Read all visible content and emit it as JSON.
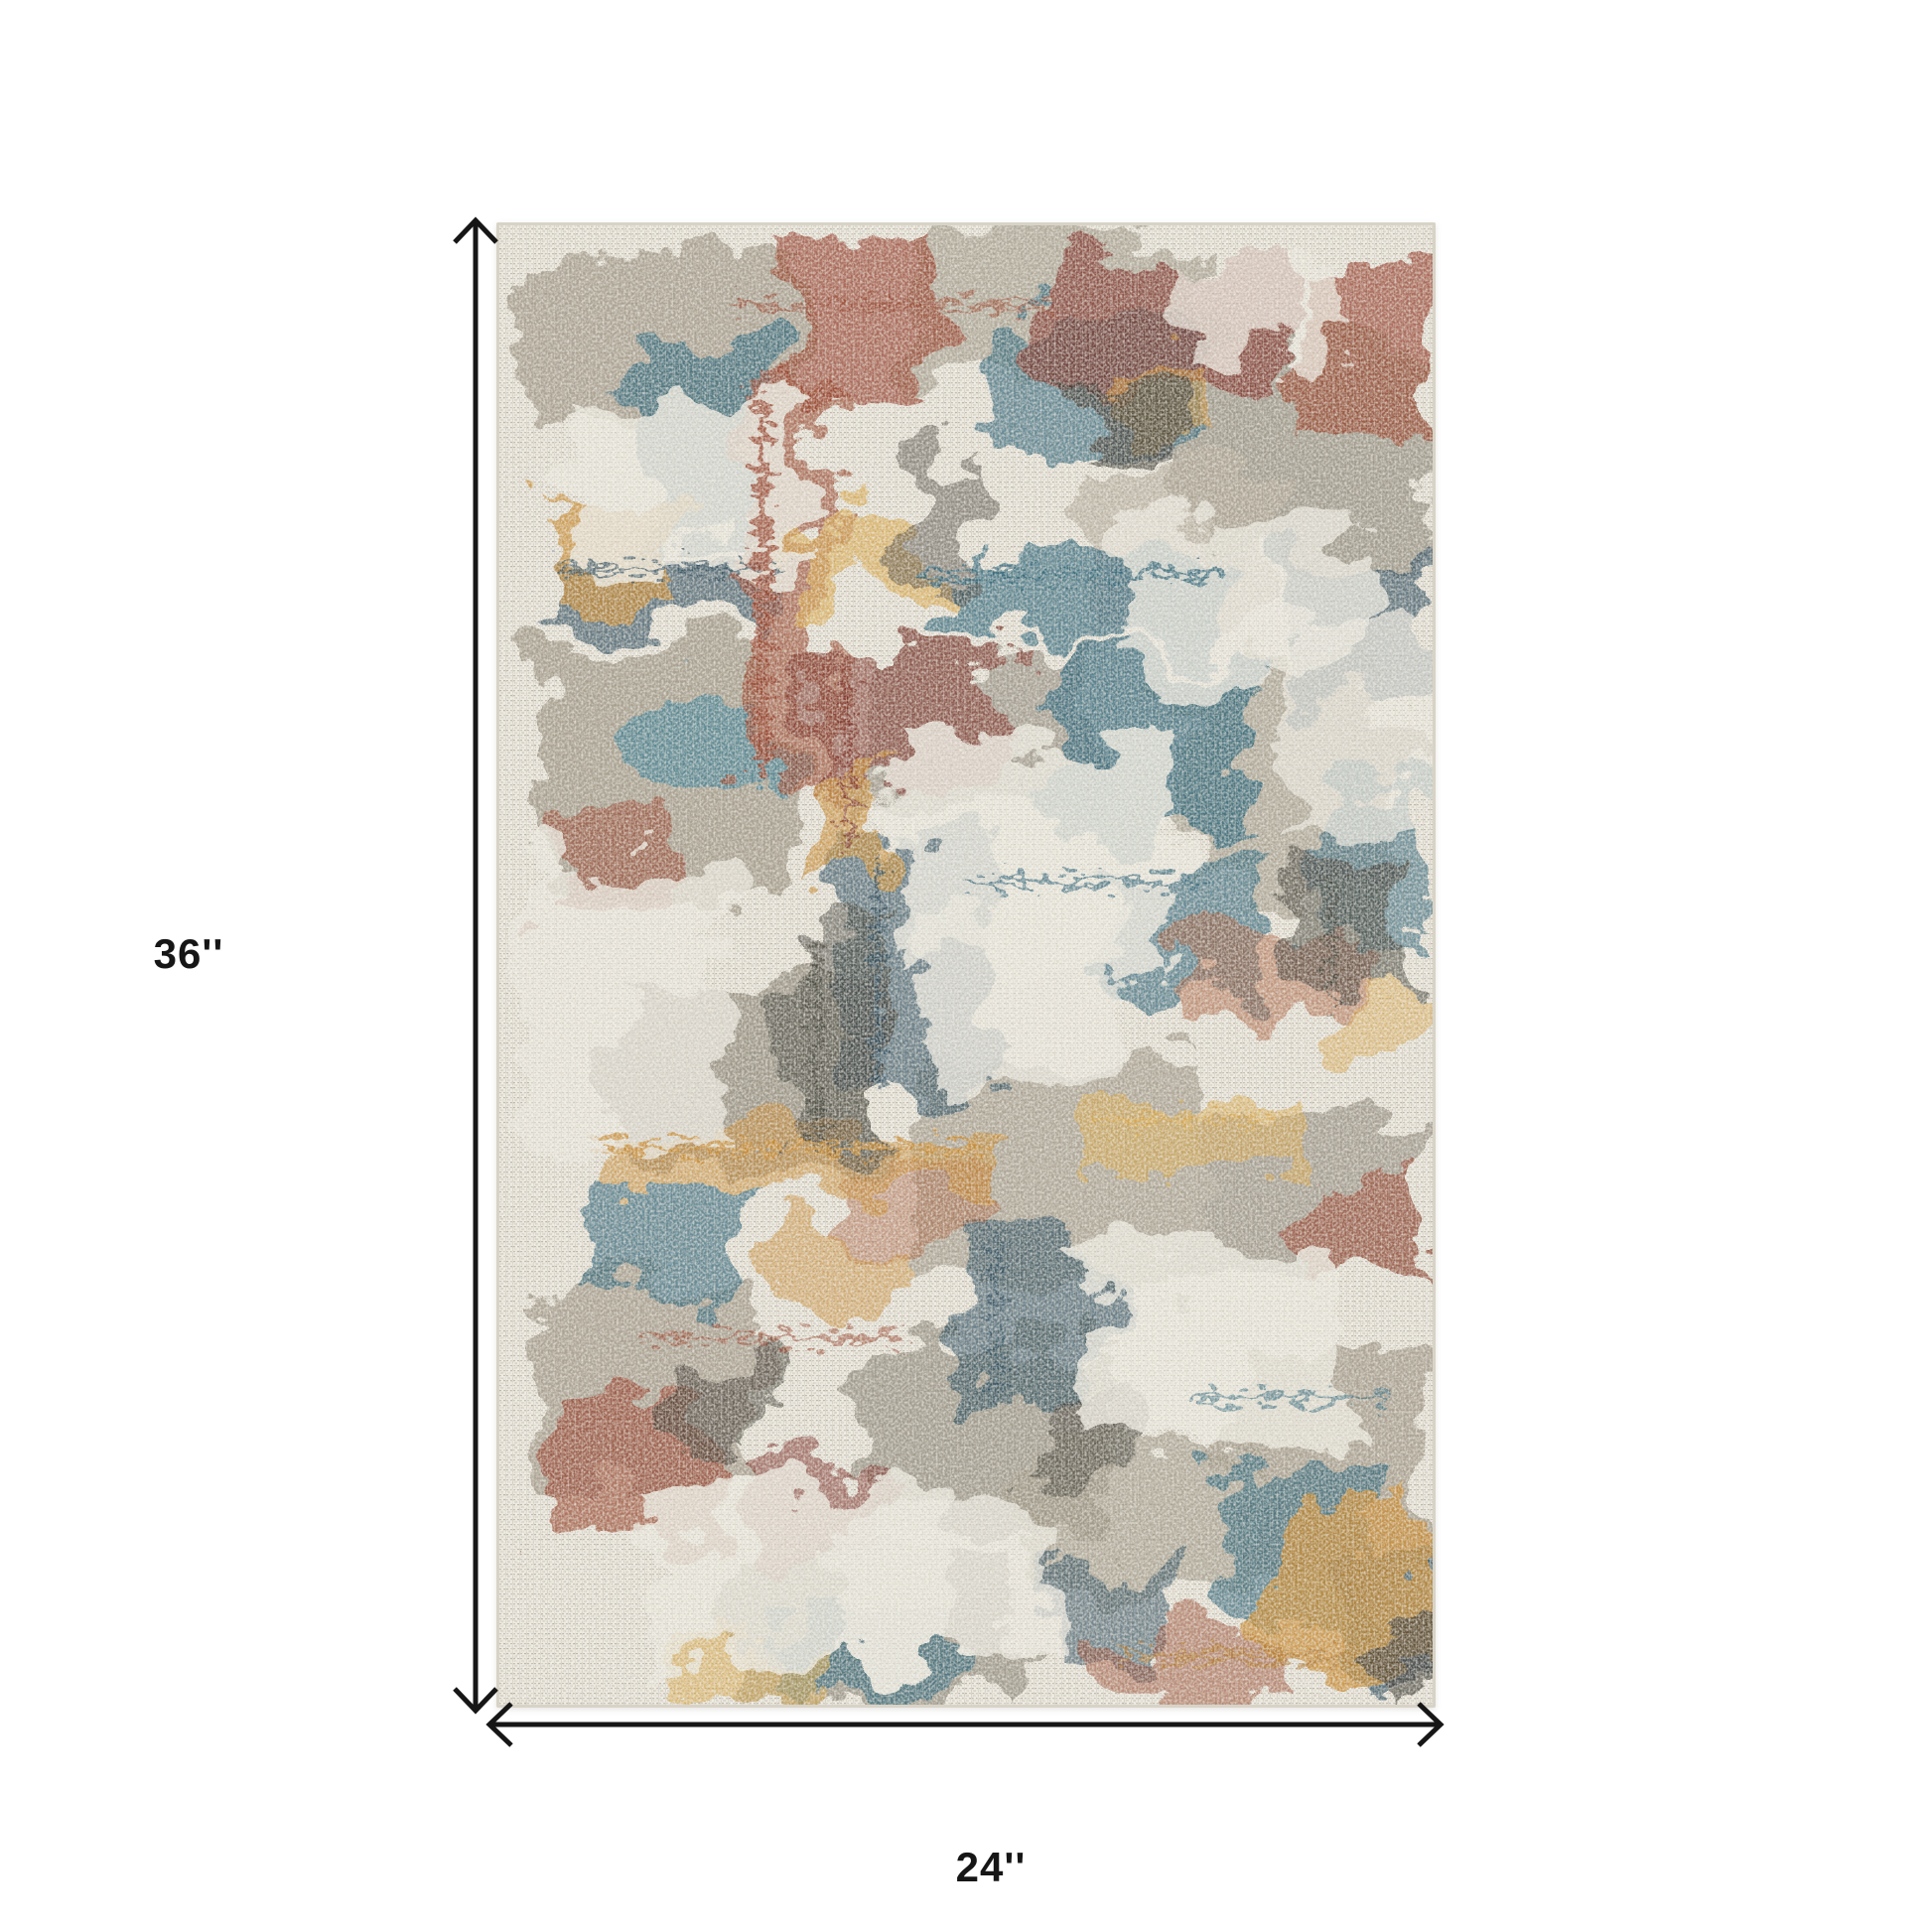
{
  "figure": {
    "type": "product-dimension-diagram",
    "height_label": "36''",
    "width_label": "24''",
    "arrow_color": "#161616",
    "label_color": "#161616",
    "background_color": "#ffffff"
  },
  "rug": {
    "description": "distressed abstract multicolor area rug, portrait orientation",
    "palette": {
      "base_ivory": "#e9e6dd",
      "taupe": "#9d9585",
      "gray": "#8b8577",
      "light_taupe": "#b0a898",
      "teal_blue": "#2f6579",
      "navy": "#27495c",
      "rust": "#96422b",
      "dark_red": "#7c2e25",
      "orange": "#a85a35",
      "gold": "#c8892f",
      "amber": "#d8a64a",
      "charcoal": "#3d3a33",
      "edge_binding": "#d8d3c7"
    }
  }
}
